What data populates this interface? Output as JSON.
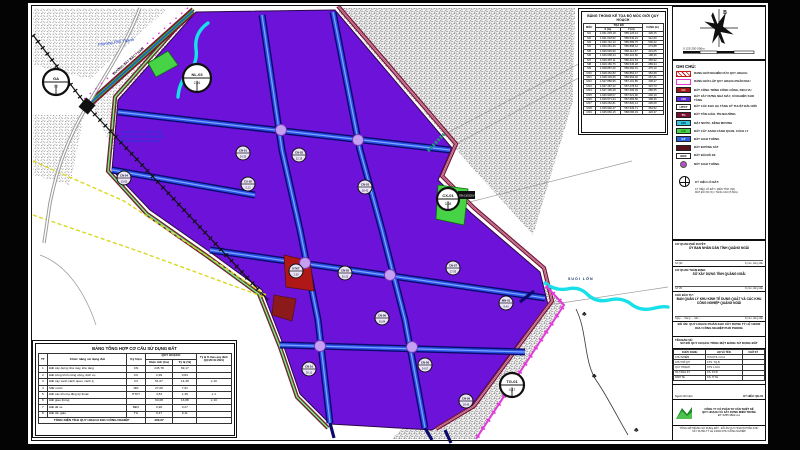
{
  "compass": {
    "north_label": "B",
    "scale_ticks": "0      125      250            500m"
  },
  "coordinate_table": {
    "title": "BẢNG THỐNG KÊ TỌA ĐỘ MỐC GIỚI QUY HOẠCH",
    "col_moc": "MỐC",
    "col_group": "TỌA ĐỘ",
    "col_x": "X (m)",
    "col_y": "Y (m)",
    "col_canh": "CẠNH (m)",
    "rows": [
      [
        "M1",
        "1.631.245,18",
        "585.126,44",
        "428,15"
      ],
      [
        "M2",
        "1.631.018,52",
        "585.540,23",
        "312,60"
      ],
      [
        "M3",
        "1.630.742,10",
        "585.689,75",
        "506,42"
      ],
      [
        "M4",
        "1.630.281,36",
        "585.898,12",
        "274,88"
      ],
      [
        "M5",
        "1.630.045,90",
        "586.114,57",
        "431,05"
      ],
      [
        "M6",
        "1.629.668,24",
        "586.322,80",
        "198,46"
      ],
      [
        "M7",
        "1.629.487,11",
        "586.401,63",
        "365,92"
      ],
      [
        "M8",
        "1.629.150,75",
        "586.545,28",
        "289,34"
      ],
      [
        "M9",
        "1.628.887,40",
        "586.660,91",
        "475,10"
      ],
      [
        "M10",
        "1.628.452,83",
        "586.852,47",
        "352,68"
      ],
      [
        "M11",
        "1.628.130,66",
        "586.994,02",
        "267,41"
      ],
      [
        "M12",
        "1.627.886,95",
        "587.101,85",
        "438,27"
      ],
      [
        "M13",
        "1.627.487,22",
        "587.278,64",
        "315,73"
      ],
      [
        "M14",
        "1.627.199,48",
        "587.406,39",
        "286,55"
      ],
      [
        "M15",
        "1.626.938,07",
        "587.521,90",
        "402,19"
      ],
      [
        "M16",
        "1.626.571,34",
        "587.683,56",
        "338,46"
      ],
      [
        "M17",
        "1.626.262,81",
        "587.820,14",
        "296,08"
      ],
      [
        "M18",
        "1.625.992,47",
        "587.939,71",
        "364,52"
      ],
      [
        "M19",
        "1.625.660,15",
        "588.086,33",
        "420,37"
      ]
    ]
  },
  "legend": {
    "title": "GHI CHÚ:",
    "items": [
      {
        "type": "outline",
        "color": "#c81818",
        "hatch": true,
        "code": "",
        "label": "RANH GIỚI NGHIÊN CỨU QUY HOẠCH"
      },
      {
        "type": "outline",
        "color": "#e23bd9",
        "code": "",
        "label": "RANH GIỚI LẬP QUY HOẠCH PHÂN KHU"
      },
      {
        "type": "fill",
        "color": "#a01616",
        "text": "#ffffff",
        "code": "CC",
        "label": "ĐẤT CÔNG TRÌNH CÔNG CỘNG, DỊCH VỤ"
      },
      {
        "type": "fill",
        "color": "#5b28d8",
        "text": "#ffffff",
        "code": "CN",
        "label": "ĐẤT XÂY DỰNG NHÀ MÁY, XÍ NGHIỆP, KHO TÀNG"
      },
      {
        "type": "fill",
        "color": "#ffffff",
        "text": "#111111",
        "code": "HTKT",
        "label": "ĐẤT CÁC KHU HẠ TẦNG KỸ THUẬT ĐẦU MỐI"
      },
      {
        "type": "fill",
        "color": "#7c1030",
        "text": "#ffffff",
        "code": "TG",
        "label": "ĐẤT TÔN GIÁO, TÍN NGƯỠNG"
      },
      {
        "type": "fill",
        "color": "#35c8e0",
        "text": "#063a3a",
        "code": "MN",
        "label": "MẶT NƯỚC, KÊNH MƯƠNG"
      },
      {
        "type": "fill",
        "color": "#46d446",
        "text": "#063a06",
        "code": "CX",
        "label": "ĐẤT CÂY XANH CẢNH QUAN, CÁCH LY"
      },
      {
        "type": "fill",
        "color": "#2e5fe0",
        "text": "#ffffff",
        "code": "GT",
        "label": "ĐẤT GIAO THÔNG"
      },
      {
        "type": "fill",
        "color": "#5a0f1c",
        "text": "#ffffff",
        "code": "",
        "label": "ĐẤT ĐƯỜNG SẮT"
      },
      {
        "type": "fill",
        "color": "#ffffff",
        "text": "#111111",
        "code": "BĐX",
        "label": "ĐẤT BÃI ĐỖ XE"
      },
      {
        "type": "dot",
        "color": "#b44fd8",
        "code": "",
        "label": "NÚT GIAO THÔNG"
      },
      {
        "type": "symbol",
        "color": "#111111",
        "code": "",
        "label": "KÝ HIỆU LÔ ĐẤT:",
        "sub": [
          "KÝ HIỆU LÔ ĐẤT / DIỆN TÍCH (HA)",
          "MẬT ĐỘ XD (%) / TẦNG CAO (TẦNG)"
        ]
      }
    ]
  },
  "map": {
    "labels": {
      "ward": "Phường Phổ Thạnh",
      "railway": "ĐƯỜNG SẮT BẮC - NAM",
      "pipe_l1": "TUYẾN ỐNG CẤP NƯỚC THÔ",
      "pipe_l2": "HIỆN TRẠNG DI DỜI (DỰ KIẾN)",
      "pipe_l3": "THEO ĐƯỜNG QUY HOẠCH",
      "stream": "SUỐI LỚN",
      "substation": "TBA 110/22KV",
      "tree": "♣"
    },
    "nodes": [
      {
        "x": 28,
        "y": 79,
        "r": 13,
        "top": "GA",
        "bottom": "TT"
      },
      {
        "x": 169,
        "y": 75,
        "r": 14,
        "top": "NL-03",
        "bottom": "2,16"
      },
      {
        "x": 420,
        "y": 196,
        "r": 11,
        "top": "CX-01",
        "bottom": "3,08"
      },
      {
        "x": 484,
        "y": 382,
        "r": 12,
        "top": "TG-01",
        "bottom": "0,47"
      }
    ],
    "parcels": [
      {
        "code": "CN-01",
        "area": "24,35",
        "x": 215,
        "y": 150
      },
      {
        "code": "CN-02",
        "area": "22,18",
        "x": 271,
        "y": 152
      },
      {
        "code": "CN-03",
        "area": "28,42",
        "x": 337,
        "y": 184
      },
      {
        "code": "CN-04",
        "area": "15,60",
        "x": 96,
        "y": 175
      },
      {
        "code": "CN-05",
        "area": "30,25",
        "x": 317,
        "y": 270
      },
      {
        "code": "CN-06",
        "area": "26,84",
        "x": 354,
        "y": 315
      },
      {
        "code": "CN-07",
        "area": "27,93",
        "x": 425,
        "y": 265
      },
      {
        "code": "CN-08",
        "area": "24,07",
        "x": 397,
        "y": 362
      },
      {
        "code": "CN-09",
        "area": "18,46",
        "x": 438,
        "y": 398
      },
      {
        "code": "CN-10",
        "area": "20,11",
        "x": 281,
        "y": 366
      },
      {
        "code": "CX-02",
        "area": "5,12",
        "x": 220,
        "y": 181
      },
      {
        "code": "MN-01",
        "area": "8,40",
        "x": 478,
        "y": 300
      },
      {
        "code": "HTKT",
        "area": "2,35",
        "x": 268,
        "y": 268
      }
    ],
    "colors": {
      "industrial": "#6c12d9",
      "road_fill": "#2b50e6",
      "road_edge": "#0a0a6e",
      "water": "#17e0e8",
      "green": "#46d446",
      "boundary_pink": "#e23bd9",
      "boundary_maroon": "#7e1436"
    }
  },
  "land_use_table": {
    "title": "BẢNG TỔNG HỢP CƠ CẤU SỬ DỤNG ĐẤT",
    "h_tt": "TT",
    "h_name": "Chức năng sử dụng đất",
    "h_code": "Ký hiệu",
    "h_group": "QUY HOẠCH",
    "h_area": "Diện tích (ha)",
    "h_ratio": "Tỷ lệ (%)",
    "h_norm": "Tỷ lệ % theo quy định (QCVN 01:2021)",
    "rows": [
      [
        "1",
        "Đất xây dựng nhà máy, kho tàng",
        "CN",
        "245,78",
        "69,17",
        ""
      ],
      [
        "2",
        "Đất công trình công cộng, dịch vụ",
        "CC",
        "2,99",
        "0,84",
        ""
      ],
      [
        "3",
        "Đất cây xanh cảnh quan, cách ly",
        "CX",
        "51,07",
        "14,38",
        "≥ 10"
      ],
      [
        "4",
        "Mặt nước",
        "MN",
        "27,05",
        "7,61",
        ""
      ],
      [
        "5",
        "Đất các khu hạ tầng kỹ thuật",
        "HTKT",
        "4,83",
        "1,36",
        "≥ 1"
      ],
      [
        "6",
        "Đất giao thông",
        "",
        "64,08",
        "13,88",
        "≥ 10"
      ],
      [
        "7",
        "Đất để xe",
        "BĐX",
        "0,96",
        "0,27",
        ""
      ],
      [
        "8",
        "Đất tôn giáo",
        "TG",
        "0,47",
        "0,11",
        ""
      ]
    ],
    "total_label": "TỔNG DIỆN TÍCH QUY HOẠCH KHU CÔNG NGHIỆP",
    "total_area": "466,07"
  },
  "title_block": {
    "s1_label": "CƠ QUAN PHÊ DUYỆT:",
    "s1_value": "ỦY BAN NHÂN DÂN TỈNH QUẢNG NGÃI",
    "s1_sign_l": "Số QĐ:",
    "s1_sign_r": "Ký tên, đóng dấu",
    "s2_label": "CƠ QUAN THẨM ĐỊNH:",
    "s2_value": "SỞ XÂY DỰNG TỈNH QUẢNG NGÃI",
    "s2_sign_l": "Số VB:",
    "s2_sign_r": "Ký tên, đóng dấu",
    "s3_label": "CHỦ ĐẦU TƯ:",
    "s3_value": "BAN QUẢN LÝ KHU KINH TẾ DUNG QUẤT VÀ CÁC KHU CÔNG NGHIỆP QUẢNG NGÃI",
    "s3_sign_l": "Ngày … tháng … năm …",
    "s3_sign_r": "Ký tên, đóng dấu",
    "project_l1": "ĐỒ ÁN: QUY HOẠCH PHÂN KHU XÂY DỰNG TỶ LỆ 1/2000",
    "project_l2": "KHU CÔNG NGHIỆP PHỔ PHONG",
    "drawing_label": "TÊN BẢN VẼ:",
    "drawing_value": "SƠ ĐỒ QUY HOẠCH TỔNG MẶT BẰNG SỬ DỤNG ĐẤT",
    "sig_headers": [
      "CHỨC DANH",
      "HỌ VÀ TÊN",
      "CHỮ KÝ"
    ],
    "signatures": [
      [
        "CHỦ NHIỆM",
        "ThS.KTS. N.V.A"
      ],
      [
        "CHỦ TRÌ QH",
        "KTS. T.Q.B"
      ],
      [
        "QUY HOẠCH",
        "KTS. L.M.C"
      ],
      [
        "HẠ TẦNG KT",
        "KS. P.V.D"
      ],
      [
        "KINH TẾ",
        "KS. H.T.E"
      ]
    ],
    "note_left": "Người thể hiện:",
    "note_right": "KÝ HIỆU: QH-04",
    "company_l1": "CÔNG TY CỔ PHẦN TƯ VẤN THIẾT KẾ",
    "company_l2": "QUY HOẠCH VÀ XÂY DỰNG MIỀN TRUNG",
    "company_l3": "ĐT: 0255.3822.xxx",
    "cap_l1": "TỔNG MẶT BẰNG SỬ DỤNG ĐẤT - ĐỒ ÁN QUY HOẠCH PHÂN KHU",
    "cap_l2": "XÂY DỰNG TỶ LỆ 1/2000 KHU CÔNG NGHIỆP"
  }
}
